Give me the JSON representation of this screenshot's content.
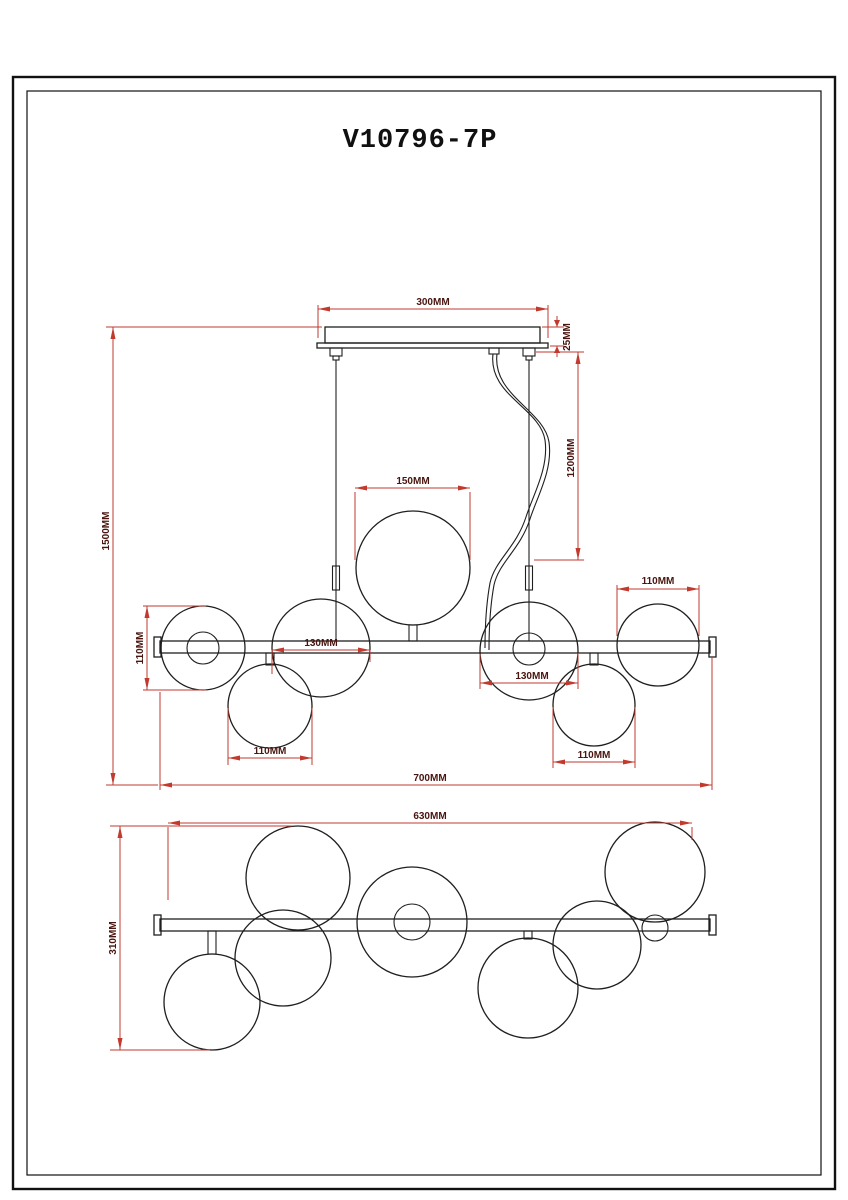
{
  "page": {
    "title": "V10796-7P"
  },
  "colors": {
    "drawing_line": "#1f1f1f",
    "dimension_line": "#c23a2e",
    "dimension_text": "#49150f",
    "background": "#ffffff"
  },
  "front_view": {
    "dims": {
      "canopy_width": "300MM",
      "canopy_height": "25MM",
      "suspension_length": "1200MM",
      "overall_height": "1500MM",
      "center_globe_width": "150MM",
      "left_globe_height": "110MM",
      "left_globe_width": "130MM",
      "right_globe_width": "130MM",
      "top_right_globe_width": "110MM",
      "bottom_left_globe_width": "110MM",
      "bottom_right_globe_width": "110MM",
      "overall_width": "700MM"
    }
  },
  "bottom_view": {
    "dims": {
      "bar_width": "630MM",
      "overall_depth": "310MM"
    }
  }
}
